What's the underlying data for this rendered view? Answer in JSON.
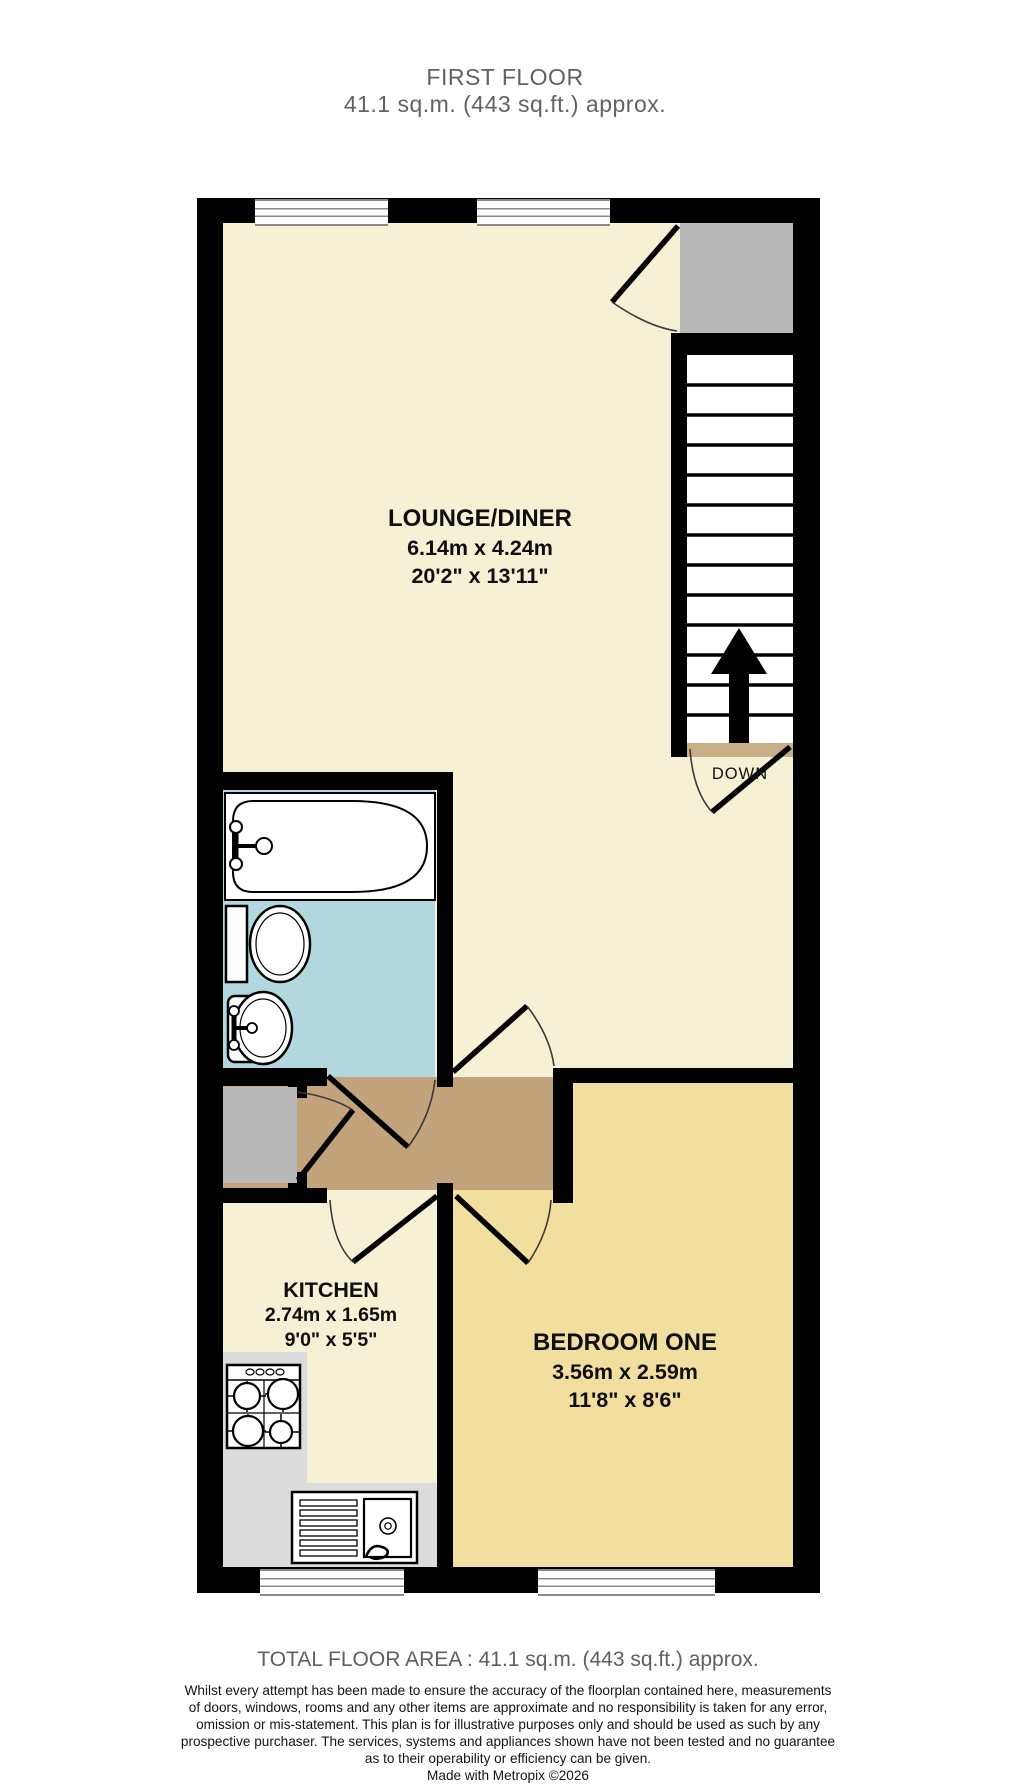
{
  "title": {
    "line1": "FIRST FLOOR",
    "line2": "41.1 sq.m. (443 sq.ft.) approx."
  },
  "rooms": {
    "lounge": {
      "name": "LOUNGE/DINER",
      "metric": "6.14m  x 4.24m",
      "imperial": "20'2\"  x 13'11\""
    },
    "kitchen": {
      "name": "KITCHEN",
      "metric": "2.74m  x 1.65m",
      "imperial": "9'0\"  x 5'5\""
    },
    "bedroom": {
      "name": "BEDROOM ONE",
      "metric": "3.56m  x 2.59m",
      "imperial": "11'8\"  x 8'6\""
    }
  },
  "labels": {
    "down": "DOWN"
  },
  "footer": {
    "total": "TOTAL FLOOR AREA : 41.1 sq.m. (443 sq.ft.) approx.",
    "disclaimer_lines": [
      "Whilst every attempt has been made to ensure the accuracy of the floorplan contained here, measurements",
      "of doors, windows, rooms and any other items are approximate and no responsibility is taken for any error,",
      "omission or mis-statement. This plan is for illustrative purposes only and should be used as such by any",
      "prospective purchaser. The services, systems and appliances shown have not been tested and no guarantee",
      "as to their operability or efficiency can be given.",
      "Made with Metropix ©2026"
    ]
  },
  "fixtures": [
    "bath",
    "toilet",
    "hand-basin",
    "cooker-hob",
    "sink-drainer",
    "staircase",
    "up-arrow",
    "cupboard",
    "landing"
  ],
  "colors": {
    "cream": "#f6f0d5",
    "bedroom": "#f2dfa0",
    "hall": "#c2a37c",
    "bathroom": "#b2d7de",
    "landing_gray": "#b9b9b9",
    "counter": "#dcdcdc",
    "stair_thresh": "#c9af87",
    "wall": "#000000",
    "window_line": "#8a8a8a",
    "title_text": "#626262",
    "footer_text": "#5f5f5f"
  }
}
